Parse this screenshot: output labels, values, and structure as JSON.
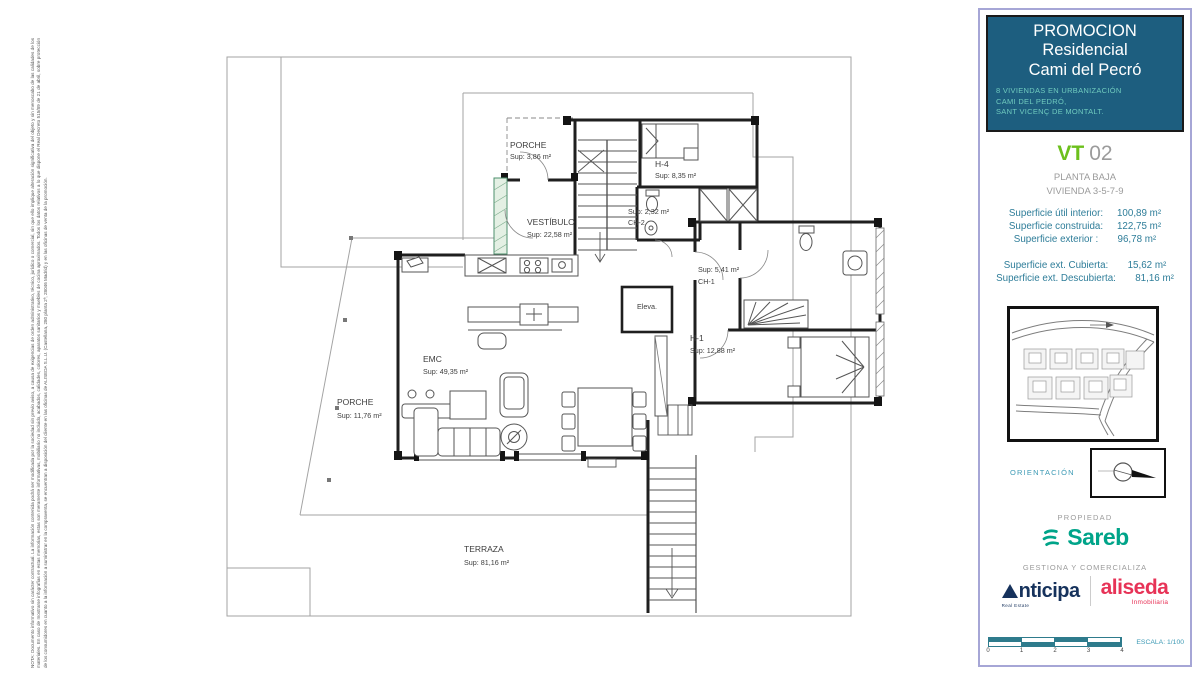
{
  "colors": {
    "panel_border": "#a6a6d6",
    "header_bg": "#1d5e7f",
    "header_title": "#ffffff",
    "header_subtitle": "#6fcabe",
    "vt_green": "#6cc01c",
    "muted_gray": "#9b9b9b",
    "surface_teal": "#2e7d99",
    "orientation_teal": "#3d9ab5",
    "sareb_teal": "#00a489",
    "anticipa_navy": "#16325c",
    "aliseda_red": "#e73357",
    "scale_teal": "#2e7b8c",
    "plan_green_wall": "#4d8f6d"
  },
  "disclaimer": "NOTA: Documento informativo sin carácter contractual. La información contenida podrá ser modificada por la sociedad sin previo aviso, a causa de exigencias de orden administrativo, técnico, jurídico o comercial, sin que ello implique alteración significativa del objeto y sin menoscabo de las calidades de los materiales. En caso de mostrarse infografías en estas memorias, estas son meramente informativas, mobiliario no incluido, acabados, calidades, colores, aparatos sanitarios y muebles de cocina aproximados. Todos los datos relativos a lo que dispone el Real Decreto 515/89 de 21 de abril, sobre protección de los consumidores en cuanto a la información a suministrar en la compraventa, se encuentran a disposición del cliente en las oficinas de ALISEDA S.L.U. (Castellana, 280 planta 2ª, 28046 Madrid) y en las oficinas de venta de la promoción.",
  "plan": {
    "rooms": {
      "porche_top": {
        "name": "PORCHE",
        "sup": "Sup: 3,86 m²"
      },
      "h4": {
        "name": "H-4",
        "sup": "Sup: 8,35 m²"
      },
      "ch2": {
        "sup": "Sup: 2,32 m²",
        "name": "CH-2"
      },
      "vestibulo": {
        "name": "VESTÍBULO",
        "sup": "Sup: 22,58 m²"
      },
      "ch1": {
        "sup": "Sup: 5,41 m²",
        "name": "CH-1"
      },
      "elevator": {
        "name": "Eleva."
      },
      "h1": {
        "name": "H-1",
        "sup": "Sup: 12,88 m²"
      },
      "emc": {
        "name": "EMC",
        "sup": "Sup: 49,35 m²"
      },
      "porche_left": {
        "name": "PORCHE",
        "sup": "Sup: 11,76 m²"
      },
      "terraza": {
        "name": "TERRAZA",
        "sup": "Sup: 81,16 m²"
      }
    }
  },
  "panel": {
    "header": {
      "line1": "PROMOCION",
      "line2": "Residencial",
      "line3": "Cami del Pecró",
      "sub1": "8 VIVIENDAS EN URBANIZACIÓN",
      "sub2": "CAMI DEL PEDRÓ,",
      "sub3": "SANT VICENÇ DE MONTALT."
    },
    "unit": {
      "code": "VT",
      "number": "02",
      "floor": "PLANTA BAJA",
      "homes": "VIVIENDA 3-5-7-9"
    },
    "surfaces_main": [
      {
        "label": "Superficie útil interior:",
        "value": "100,89 m²"
      },
      {
        "label": "Superficie construida:",
        "value": "122,75 m²"
      },
      {
        "label": "Superficie exterior :",
        "value": "96,78 m²"
      }
    ],
    "surfaces_ext": [
      {
        "label": "Superficie ext. Cubierta:",
        "value": "15,62 m²"
      },
      {
        "label": "Superficie ext. Descubierta:",
        "value": "81,16 m²"
      }
    ],
    "orientation_label": "ORIENTACIÓN",
    "propiedad_label": "PROPIEDAD",
    "sareb_name": "Sareb",
    "gestiona_label": "GESTIONA Y COMERCIALIZA",
    "anticipa": {
      "word": "nticipa",
      "caption": "Real Estate"
    },
    "aliseda": {
      "word": "aliseda",
      "caption": "Inmobiliaria"
    },
    "scale": {
      "label": "ESCALA: 1/100",
      "ticks": [
        "0",
        "1",
        "2",
        "3",
        "4"
      ]
    }
  }
}
